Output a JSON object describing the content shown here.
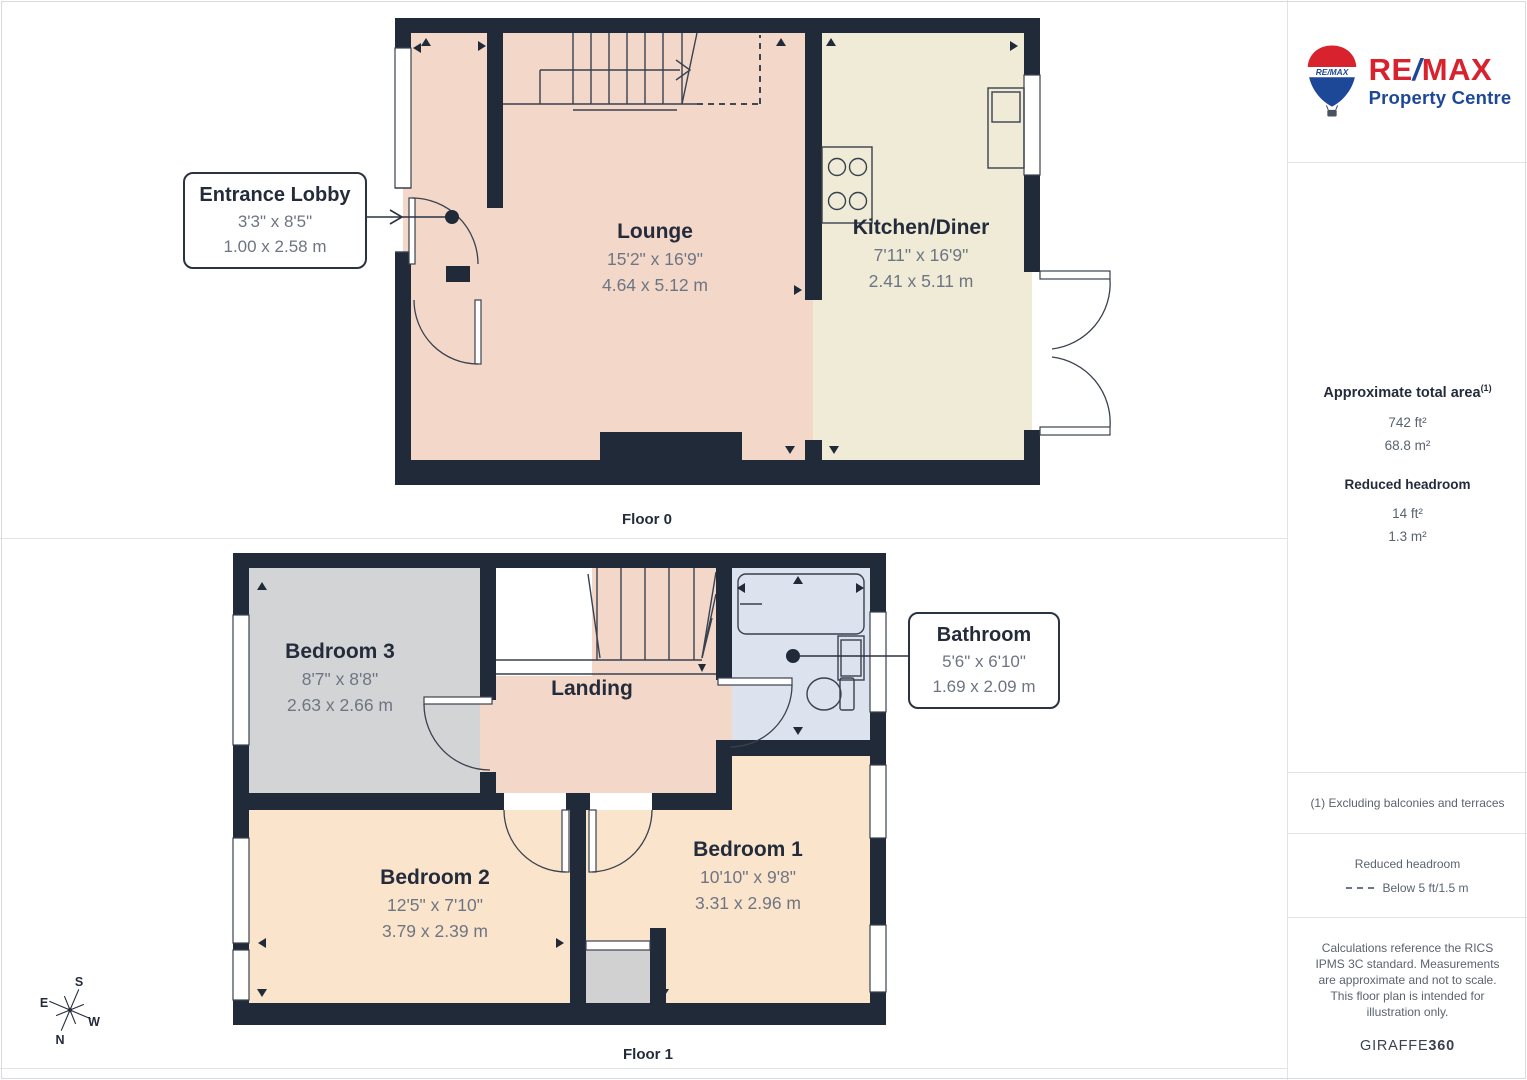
{
  "logo": {
    "balloon_text": "RE/MAX",
    "wordmark_re": "RE",
    "wordmark_slash": "/",
    "wordmark_max": "MAX",
    "tagline": "Property Centre"
  },
  "sidebar": {
    "area_title": "Approximate total area",
    "area_superscript": "(1)",
    "area_ft": "742 ft²",
    "area_m": "68.8 m²",
    "headroom_title": "Reduced headroom",
    "headroom_ft": "14 ft²",
    "headroom_m": "1.3 m²",
    "footnote": "(1) Excluding balconies and terraces",
    "legend_title": "Reduced headroom",
    "legend_label": "Below 5 ft/1.5 m",
    "disclaimer": "Calculations reference the RICS IPMS 3C standard. Measurements are approximate and not to scale. This floor plan is intended for illustration only.",
    "footer_brand": "GIRAFFE",
    "footer_brand_bold": "360"
  },
  "floor0": {
    "label": "Floor 0",
    "lounge": {
      "name": "Lounge",
      "imperial": "15'2\" x 16'9\"",
      "metric": "4.64 x 5.12 m"
    },
    "kitchen": {
      "name": "Kitchen/Diner",
      "imperial": "7'11\" x 16'9\"",
      "metric": "2.41 x 5.11 m"
    },
    "lobby": {
      "name": "Entrance Lobby",
      "imperial": "3'3\" x 8'5\"",
      "metric": "1.00 x 2.58 m"
    }
  },
  "floor1": {
    "label": "Floor 1",
    "bedroom3": {
      "name": "Bedroom 3",
      "imperial": "8'7\" x 8'8\"",
      "metric": "2.63 x 2.66 m"
    },
    "landing": {
      "name": "Landing"
    },
    "bathroom": {
      "name": "Bathroom",
      "imperial": "5'6\" x 6'10\"",
      "metric": "1.69 x 2.09 m"
    },
    "bedroom2": {
      "name": "Bedroom 2",
      "imperial": "12'5\" x 7'10\"",
      "metric": "3.79 x 2.39 m"
    },
    "bedroom1": {
      "name": "Bedroom 1",
      "imperial": "10'10\" x 9'8\"",
      "metric": "3.31 x 2.96 m"
    }
  },
  "compass": {
    "n": "N",
    "s": "S",
    "e": "E",
    "w": "W"
  }
}
